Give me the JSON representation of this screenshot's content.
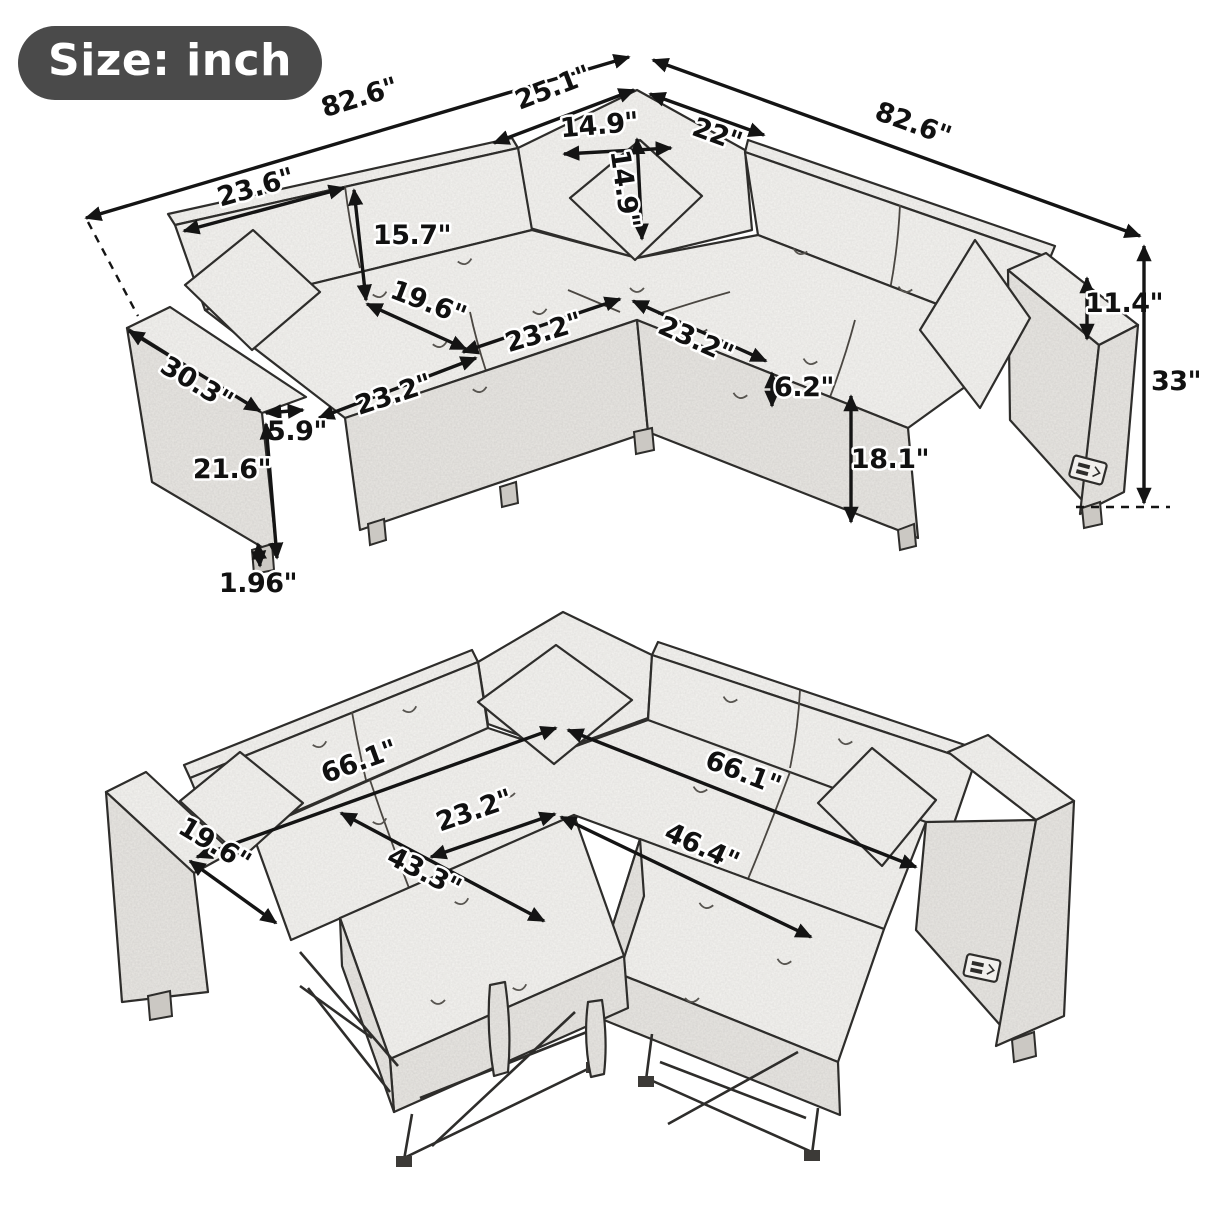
{
  "badge": {
    "label": "Size: inch"
  },
  "palette": {
    "ink": "#2e2d2b",
    "label_ink": "#111111",
    "badge_bg": "#4a4a4a",
    "badge_text": "#ffffff",
    "fabric": "#f5f3f0",
    "paper": "#ffffff"
  },
  "views": {
    "assembled": {
      "dims": {
        "total_width_left": "82.6\"",
        "corner_back_width": "25.1\"",
        "corner_seat_back_width": "22\"",
        "total_width_right": "82.6\"",
        "back_cushion_width": "23.6\"",
        "pillow_width": "14.9\"",
        "pillow_height": "14.9\"",
        "back_cushion_height": "15.7\"",
        "seat_depth": "19.6\"",
        "seat_width_left": "23.2\"",
        "seat_width_right": "23.2\"",
        "front_rail_width": "23.2\"",
        "arm_depth": "30.3\"",
        "arm_width": "5.9\"",
        "arm_height": "21.6\"",
        "leg_height": "1.96\"",
        "cushion_thickness": "6.2\"",
        "seat_height": "18.1\"",
        "back_above_arm": "11.4\"",
        "overall_height": "33\""
      }
    },
    "bed": {
      "dims": {
        "bed_length_left": "66.1\"",
        "bed_length_right": "66.1\"",
        "bed_center_width": "23.2\"",
        "pullout_length": "46.4\"",
        "seat_depth": "19.6\"",
        "pullout_width": "43.3\""
      }
    }
  }
}
